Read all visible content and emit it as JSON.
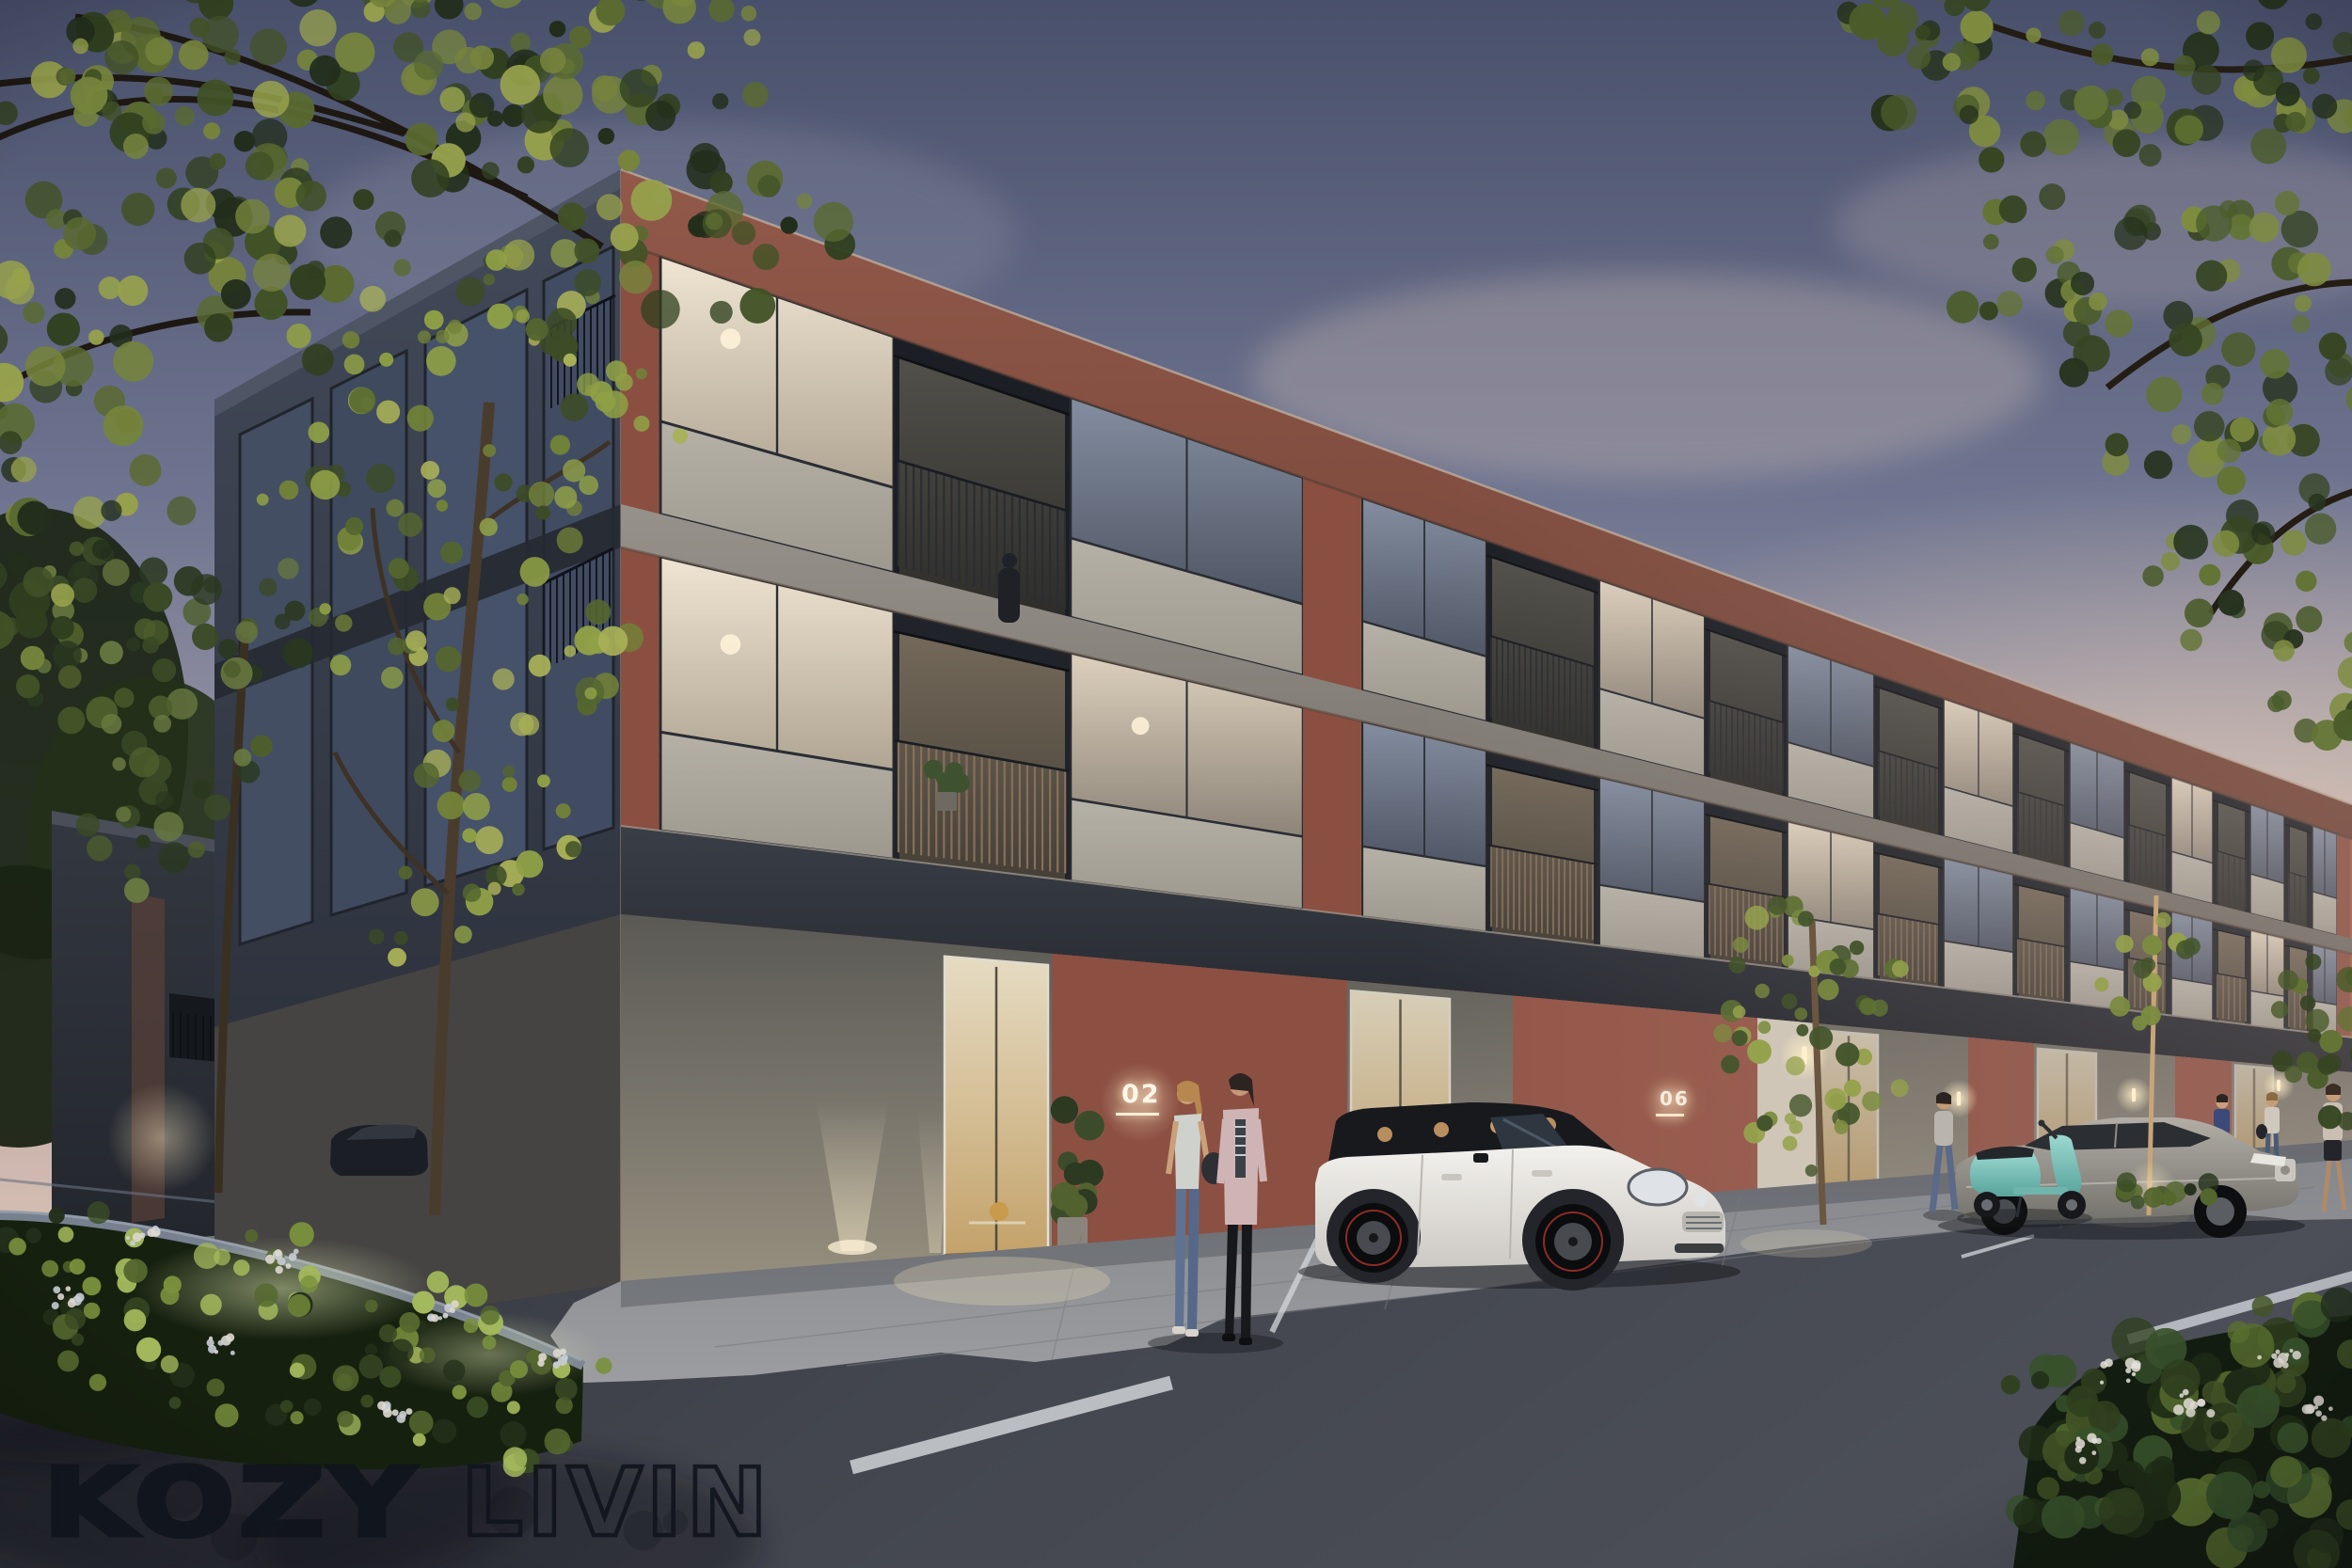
{
  "branding": {
    "logo_primary": "KOZY",
    "logo_secondary": "LIVIN"
  },
  "signage": {
    "unit_numbers": [
      "02",
      "06"
    ]
  },
  "palette": {
    "sky_top": "#49506b",
    "sky_mid": "#8d91a6",
    "sky_horizon": "#dfc6b6",
    "brick_red": "#9c5b49",
    "brick_shadow": "#6d4337",
    "fascia_dark": "#2b2f36",
    "concrete_slab": "#8d8a84",
    "spandrel": "#b2ada3",
    "ground_brick": "#77746e",
    "asphalt": "#3a3d44",
    "pavement": "#8f9195",
    "curb": "#77808f",
    "foliage_dark": "#2e3b24",
    "foliage_light": "#6d7f42",
    "window_glow": "#e9dcc3",
    "lamp_glow": "#ffe7bd",
    "mini_white": "#eceae6",
    "mini_roof": "#17191d",
    "scooter_teal": "#86ccc4",
    "sedan_silver": "#a8a49c",
    "logo_ink": "#10141c"
  }
}
